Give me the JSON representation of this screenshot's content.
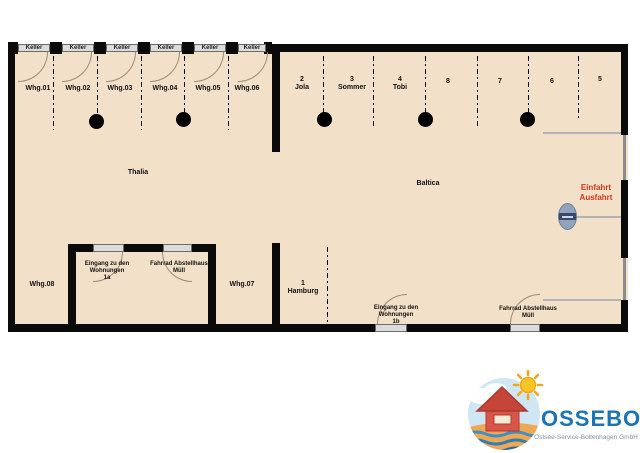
{
  "thalia": {
    "name": "Thalia",
    "keller_label": "Keller",
    "units": [
      "Whg.01",
      "Whg.02",
      "Whg.03",
      "Whg.04",
      "Whg.05",
      "Whg.06"
    ],
    "unit07": "Whg.07",
    "unit08": "Whg.08",
    "entrance_room": {
      "entrance_door_lines": [
        "Eingang zu den",
        "Wohnungen",
        "1a"
      ],
      "bike_shed_lines": [
        "Fahrrad Abstellhaus",
        "Müll"
      ]
    }
  },
  "baltica": {
    "name": "Baltica",
    "spots": [
      {
        "number": "2",
        "label": "Jola"
      },
      {
        "number": "3",
        "label": "Sommer"
      },
      {
        "number": "4",
        "label": "Tobi"
      },
      {
        "number": "8",
        "label": ""
      },
      {
        "number": "7",
        "label": ""
      },
      {
        "number": "6",
        "label": ""
      },
      {
        "number": "5",
        "label": ""
      },
      {
        "number": "1",
        "label": "Hamburg"
      }
    ],
    "entrance_door_lines": [
      "Eingang zu den",
      "Wohnungen",
      "1b"
    ],
    "bike_shed_lines": [
      "Fahrrad Abstellhaus",
      "Müll"
    ],
    "gate_label_lines": [
      "Einfahrt",
      "Ausfahrt"
    ]
  },
  "logo": {
    "brand": "OSSEBO",
    "subtitle": "Ostsee-Service-Boltenhagen GmbH"
  },
  "colors": {
    "floor": "#f2e0c8",
    "wall": "#0a0a0a",
    "gate_text": "#d2381c",
    "logo_blue": "#1b74b4"
  }
}
